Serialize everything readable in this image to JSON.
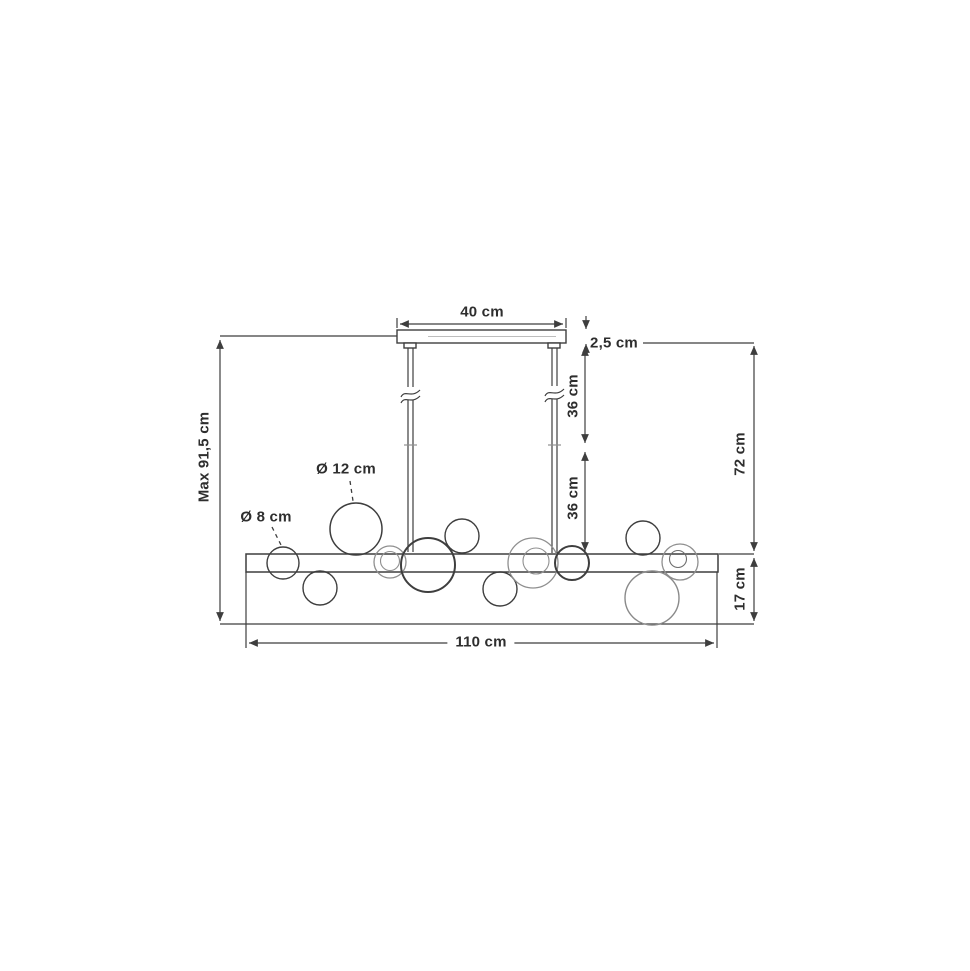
{
  "title": "Pendant lamp dimensional drawing",
  "diagram": {
    "subject": "linear pendant lamp with glass bubble globes, front view with dimensions",
    "dimensions": {
      "canopy_width": "40 cm",
      "canopy_height": "2,5 cm",
      "rod_upper": "36 cm",
      "rod_lower": "36 cm",
      "drop_height": "72 cm",
      "max_height": "Max 91,5 cm",
      "globe_large_diameter": "Ø 12 cm",
      "globe_small_diameter": "Ø 8 cm",
      "bar_width": "110 cm",
      "fixture_height": "17 cm"
    },
    "colors": {
      "line": "#3e3e3e",
      "light_line": "#8f8f8f",
      "text": "#2e2e2e",
      "background": "#ffffff"
    }
  }
}
